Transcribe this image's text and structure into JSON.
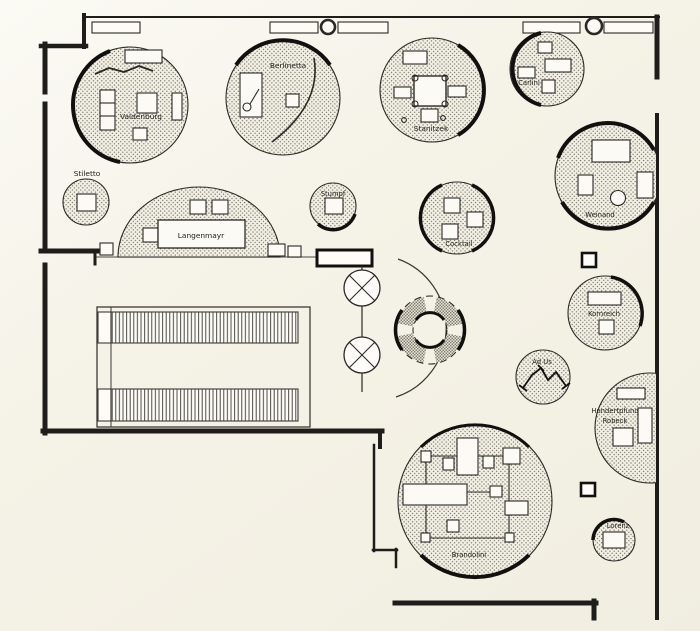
{
  "plan": {
    "colors": {
      "paper": "#f5f2e7",
      "ink": "#1f1d1a",
      "stipple_dot": "#6b665a",
      "furniture_fill": "#fbfaf5"
    },
    "booths": {
      "valdenburg": {
        "label": "Valdenburg"
      },
      "berlinetta": {
        "label": "Berlinetta"
      },
      "stanitzek": {
        "label": "Stanitzek"
      },
      "carlini": {
        "label": "Carlini"
      },
      "stiletto": {
        "label": "Stiletto"
      },
      "langenmayr": {
        "label": "Langenmayr"
      },
      "stumpf": {
        "label": "Stumpf"
      },
      "cocktail": {
        "label": "Cocktail"
      },
      "weinand": {
        "label": "Weinand"
      },
      "kornreich": {
        "label": "Kornreich"
      },
      "ad_us": {
        "label": "Ad Us"
      },
      "hundertpfund": {
        "label_line1": "Hundertpfund",
        "label_line2": "Robeck"
      },
      "brandolini": {
        "label": "Brandolini"
      },
      "lorenz": {
        "label": "Lorenz"
      }
    }
  }
}
